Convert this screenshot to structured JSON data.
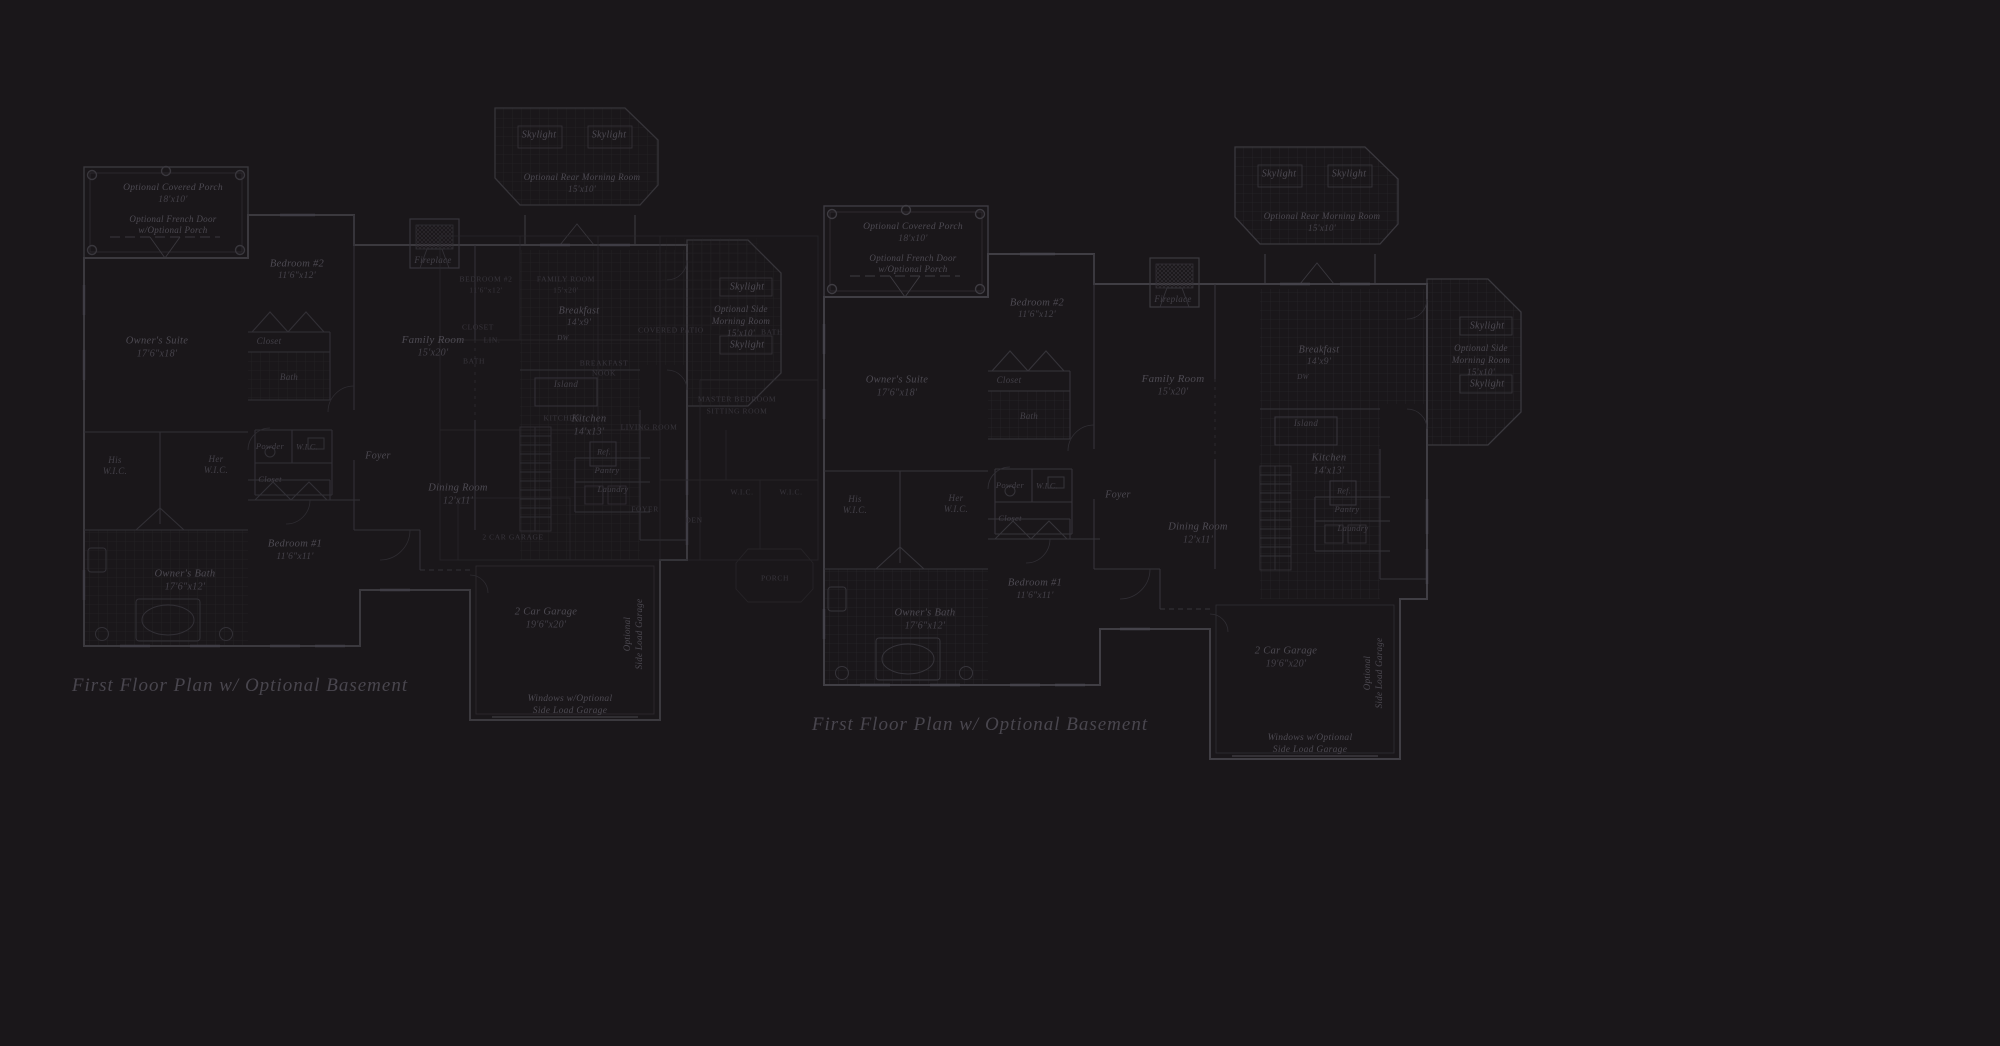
{
  "background": "#1a171a",
  "colors": {
    "wall": "#3e3c42",
    "minor_line": "#312f35",
    "tile_line": "#262428",
    "label_text": "#4d4a52",
    "overlay_text": "#38353c",
    "title_text": "#49464e"
  },
  "plans": [
    {
      "id": "left",
      "title": "First Floor Plan  w/ Optional Basement",
      "dx": 0,
      "dy": 0
    },
    {
      "id": "right",
      "title": "First Floor Plan  w/ Optional Basement",
      "dx": 740,
      "dy": 39
    }
  ],
  "title_pos": {
    "x": 160,
    "y": 586
  },
  "room_labels": [
    {
      "id": "opt-covered-porch",
      "text": "Optional Covered Porch",
      "x": 93,
      "y": 88,
      "size": 9.5
    },
    {
      "id": "opt-covered-porch-dims",
      "text": "18'x10'",
      "x": 93,
      "y": 100,
      "size": 9.5,
      "cls": "dim"
    },
    {
      "id": "opt-french-door-1",
      "text": "Optional French Door",
      "x": 93,
      "y": 119,
      "size": 9
    },
    {
      "id": "opt-french-door-2",
      "text": "w/Optional Porch",
      "x": 93,
      "y": 130,
      "size": 9
    },
    {
      "id": "owners-suite",
      "text": "Owner's Suite",
      "x": 77,
      "y": 241,
      "size": 10.5
    },
    {
      "id": "owners-suite-dims",
      "text": "17'6\"x18'",
      "x": 77,
      "y": 254,
      "size": 10,
      "cls": "dim"
    },
    {
      "id": "bedroom-2",
      "text": "Bedroom #2",
      "x": 217,
      "y": 164,
      "size": 10.5
    },
    {
      "id": "bedroom-2-dims",
      "text": "11'6\"x12'",
      "x": 217,
      "y": 176,
      "size": 9.5,
      "cls": "dim"
    },
    {
      "id": "bedroom-2-closet",
      "text": "Closet",
      "x": 189,
      "y": 241,
      "size": 9,
      "cls": "small"
    },
    {
      "id": "bedroom-2-bath",
      "text": "Bath",
      "x": 209,
      "y": 277,
      "size": 9,
      "cls": "small"
    },
    {
      "id": "fireplace",
      "text": "Fireplace",
      "x": 353,
      "y": 160,
      "size": 9,
      "cls": "small"
    },
    {
      "id": "family-room",
      "text": "Family Room",
      "x": 353,
      "y": 240,
      "size": 11
    },
    {
      "id": "family-room-dims",
      "text": "15'x20'",
      "x": 353,
      "y": 253,
      "size": 10,
      "cls": "dim"
    },
    {
      "id": "skylight-rear-left",
      "text": "Skylight",
      "x": 459,
      "y": 35,
      "size": 10
    },
    {
      "id": "skylight-rear-right",
      "text": "Skylight",
      "x": 529,
      "y": 35,
      "size": 10
    },
    {
      "id": "rear-morning-room",
      "text": "Optional Rear Morning Room",
      "x": 502,
      "y": 77,
      "size": 9
    },
    {
      "id": "rear-morning-room-dims",
      "text": "15'x10'",
      "x": 502,
      "y": 89,
      "size": 9,
      "cls": "dim"
    },
    {
      "id": "his",
      "text": "His",
      "x": 35,
      "y": 360,
      "size": 9,
      "cls": "small"
    },
    {
      "id": "his-wic",
      "text": "W.I.C.",
      "x": 35,
      "y": 371,
      "size": 9,
      "cls": "small"
    },
    {
      "id": "her",
      "text": "Her",
      "x": 136,
      "y": 359,
      "size": 9,
      "cls": "small"
    },
    {
      "id": "her-wic",
      "text": "W.I.C.",
      "x": 136,
      "y": 370,
      "size": 9,
      "cls": "small"
    },
    {
      "id": "powder",
      "text": "Powder",
      "x": 190,
      "y": 346,
      "size": 8.5,
      "cls": "small"
    },
    {
      "id": "powder-wic",
      "text": "W.I.C.",
      "x": 227,
      "y": 347,
      "size": 8,
      "cls": "small"
    },
    {
      "id": "hall-closet",
      "text": "Closet",
      "x": 190,
      "y": 379,
      "size": 8.5,
      "cls": "small"
    },
    {
      "id": "foyer",
      "text": "Foyer",
      "x": 298,
      "y": 356,
      "size": 10
    },
    {
      "id": "bedroom-1",
      "text": "Bedroom #1",
      "x": 215,
      "y": 444,
      "size": 10.5
    },
    {
      "id": "bedroom-1-dims",
      "text": "11'6\"x11'",
      "x": 215,
      "y": 457,
      "size": 9.5,
      "cls": "dim"
    },
    {
      "id": "owners-bath",
      "text": "Owner's Bath",
      "x": 105,
      "y": 474,
      "size": 10.5
    },
    {
      "id": "owners-bath-dims",
      "text": "17'6\"x12'",
      "x": 105,
      "y": 487,
      "size": 10,
      "cls": "dim"
    },
    {
      "id": "dining-room",
      "text": "Dining Room",
      "x": 378,
      "y": 388,
      "size": 10.5
    },
    {
      "id": "dining-room-dims",
      "text": "12'x11'",
      "x": 378,
      "y": 401,
      "size": 10,
      "cls": "dim"
    },
    {
      "id": "breakfast",
      "text": "Breakfast",
      "x": 499,
      "y": 211,
      "size": 10
    },
    {
      "id": "breakfast-dims",
      "text": "14'x9'",
      "x": 499,
      "y": 223,
      "size": 9.5,
      "cls": "dim"
    },
    {
      "id": "dw",
      "text": "DW",
      "x": 483,
      "y": 238,
      "size": 7,
      "cls": "small"
    },
    {
      "id": "island",
      "text": "Island",
      "x": 486,
      "y": 284,
      "size": 9,
      "cls": "small"
    },
    {
      "id": "kitchen",
      "text": "Kitchen",
      "x": 509,
      "y": 319,
      "size": 10.5
    },
    {
      "id": "kitchen-dims",
      "text": "14'x13'",
      "x": 509,
      "y": 332,
      "size": 10,
      "cls": "dim"
    },
    {
      "id": "ref",
      "text": "Ref.",
      "x": 524,
      "y": 352,
      "size": 8,
      "cls": "small"
    },
    {
      "id": "pantry",
      "text": "Pantry",
      "x": 527,
      "y": 370,
      "size": 8.5,
      "cls": "small"
    },
    {
      "id": "laundry",
      "text": "Laundry",
      "x": 533,
      "y": 389,
      "size": 8.5,
      "cls": "small"
    },
    {
      "id": "skylight-side-top",
      "text": "Skylight",
      "x": 667,
      "y": 187,
      "size": 10
    },
    {
      "id": "side-morning-room-1",
      "text": "Optional Side",
      "x": 661,
      "y": 209,
      "size": 9
    },
    {
      "id": "side-morning-room-2",
      "text": "Morning Room",
      "x": 661,
      "y": 221,
      "size": 9
    },
    {
      "id": "side-morning-room-dims",
      "text": "15'x10'",
      "x": 661,
      "y": 233,
      "size": 9,
      "cls": "dim"
    },
    {
      "id": "skylight-side-bottom",
      "text": "Skylight",
      "x": 667,
      "y": 245,
      "size": 10
    },
    {
      "id": "garage",
      "text": "2 Car Garage",
      "x": 466,
      "y": 512,
      "size": 10.5
    },
    {
      "id": "garage-dims",
      "text": "19'6\"x20'",
      "x": 466,
      "y": 525,
      "size": 10,
      "cls": "dim"
    },
    {
      "id": "garage-side-load-1",
      "text": "Optional",
      "x": 547,
      "y": 534,
      "size": 9,
      "cls": "rot"
    },
    {
      "id": "garage-side-load-2",
      "text": "Side Load Garage",
      "x": 559,
      "y": 534,
      "size": 9,
      "cls": "rot"
    },
    {
      "id": "garage-windows-1",
      "text": "Windows w/Optional",
      "x": 490,
      "y": 599,
      "size": 9.5
    },
    {
      "id": "garage-windows-2",
      "text": "Side Load Garage",
      "x": 490,
      "y": 611,
      "size": 9.5
    }
  ],
  "overlay_labels": [
    {
      "text": "BEDROOM #2",
      "x": 486,
      "y": 279
    },
    {
      "text": "11'6\"x12'",
      "x": 486,
      "y": 290
    },
    {
      "text": "FAMILY ROOM",
      "x": 566,
      "y": 279
    },
    {
      "text": "15'x20'",
      "x": 566,
      "y": 290
    },
    {
      "text": "CLOSET",
      "x": 478,
      "y": 327
    },
    {
      "text": "LIN.",
      "x": 492,
      "y": 340
    },
    {
      "text": "BATH",
      "x": 474,
      "y": 361
    },
    {
      "text": "BREAKFAST",
      "x": 604,
      "y": 363
    },
    {
      "text": "NOOK",
      "x": 604,
      "y": 373
    },
    {
      "text": "KITCHEN",
      "x": 562,
      "y": 418
    },
    {
      "text": "LIVING ROOM",
      "x": 649,
      "y": 427
    },
    {
      "text": "MASTER BEDROOM",
      "x": 737,
      "y": 399
    },
    {
      "text": "SITTING ROOM",
      "x": 737,
      "y": 411
    },
    {
      "text": "W.I.C.",
      "x": 742,
      "y": 492
    },
    {
      "text": "W.I.C.",
      "x": 791,
      "y": 492
    },
    {
      "text": "FOYER",
      "x": 645,
      "y": 509
    },
    {
      "text": "DEN",
      "x": 694,
      "y": 520
    },
    {
      "text": "2 CAR GARAGE",
      "x": 513,
      "y": 537
    },
    {
      "text": "COVERED PATIO",
      "x": 671,
      "y": 330
    },
    {
      "text": "BATH",
      "x": 772,
      "y": 332
    },
    {
      "text": "PORCH",
      "x": 775,
      "y": 578
    }
  ]
}
